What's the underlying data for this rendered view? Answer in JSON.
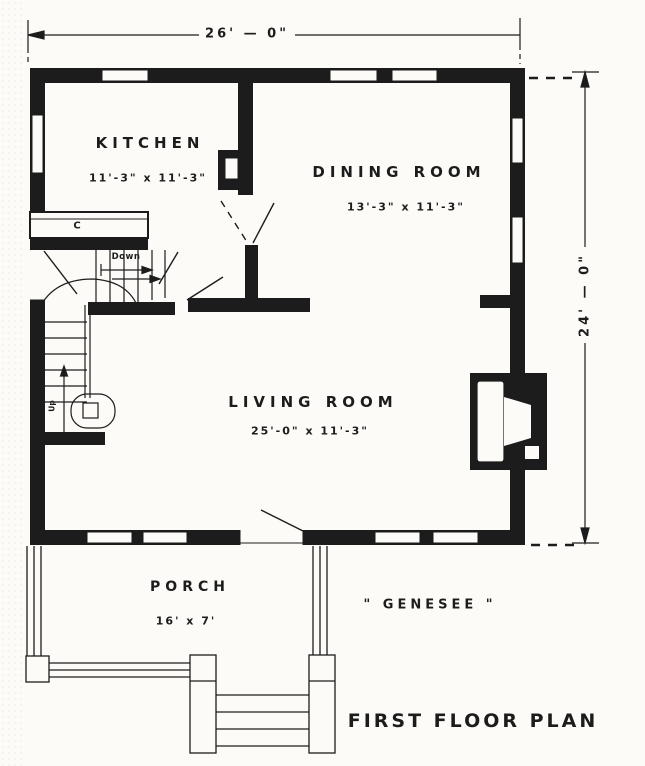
{
  "title": {
    "plan_label": "FIRST FLOOR PLAN",
    "house_name": "\" GENESEE \""
  },
  "dimensions": {
    "overall_width": "26' — 0\"",
    "overall_depth": "24' — 0\""
  },
  "rooms": {
    "kitchen": {
      "name": "KITCHEN",
      "size": "11'-3\" x 11'-3\""
    },
    "dining": {
      "name": "DINING ROOM",
      "size": "13'-3\" x 11'-3\""
    },
    "living": {
      "name": "LIVING ROOM",
      "size": "25'-0\" x 11'-3\""
    },
    "porch": {
      "name": "PORCH",
      "size": "16' x 7'"
    }
  },
  "stairs": {
    "down_label": "Down",
    "up_label": "Up"
  },
  "fixtures": {
    "counter_label": "C"
  },
  "colors": {
    "ink": "#1c1c1c",
    "paper": "#fcfbf8"
  }
}
